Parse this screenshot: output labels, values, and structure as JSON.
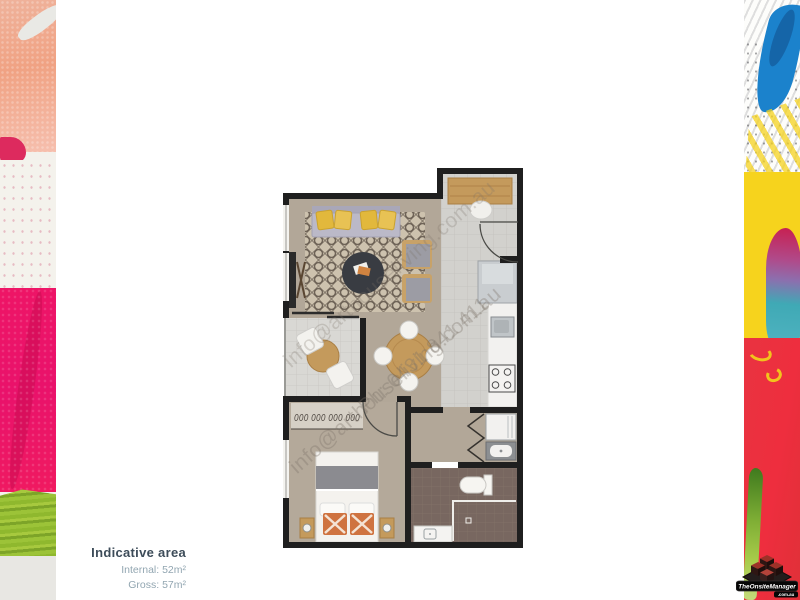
{
  "area_info": {
    "title": "Indicative area",
    "internal": "Internal: 52m²",
    "gross": "Gross: 57m²"
  },
  "watermark": {
    "email": "info@arthouseliving.com.au",
    "phone": "Ph: 0431 841 411"
  },
  "logo": {
    "title": "TheOnsiteManager",
    "domain": ".com.au"
  },
  "floorplan": {
    "hanger_glyphs": "000 000 000 000",
    "colors": {
      "wall": "#1f1f1f",
      "carpet": "#b2a798",
      "tile_light": "#d2d1cd",
      "tile_balcony": "#d9d8d4",
      "tile_bathroom": "#786760",
      "rug_base": "#cdc2ae",
      "rug_pattern": "#6e6357",
      "wood": "#c49a5c",
      "sofa": "#b6b4c3",
      "cushion_yellow": "#e2b83c",
      "cushion_orange": "#cf7340",
      "coffee_table": "#393c42"
    },
    "paint_colors": {
      "magenta": "#ee1566",
      "peach": "#f0a283",
      "green": "#8fb82e",
      "yellow": "#f6d31d",
      "red": "#e93340",
      "blue": "#1b82cc"
    }
  }
}
